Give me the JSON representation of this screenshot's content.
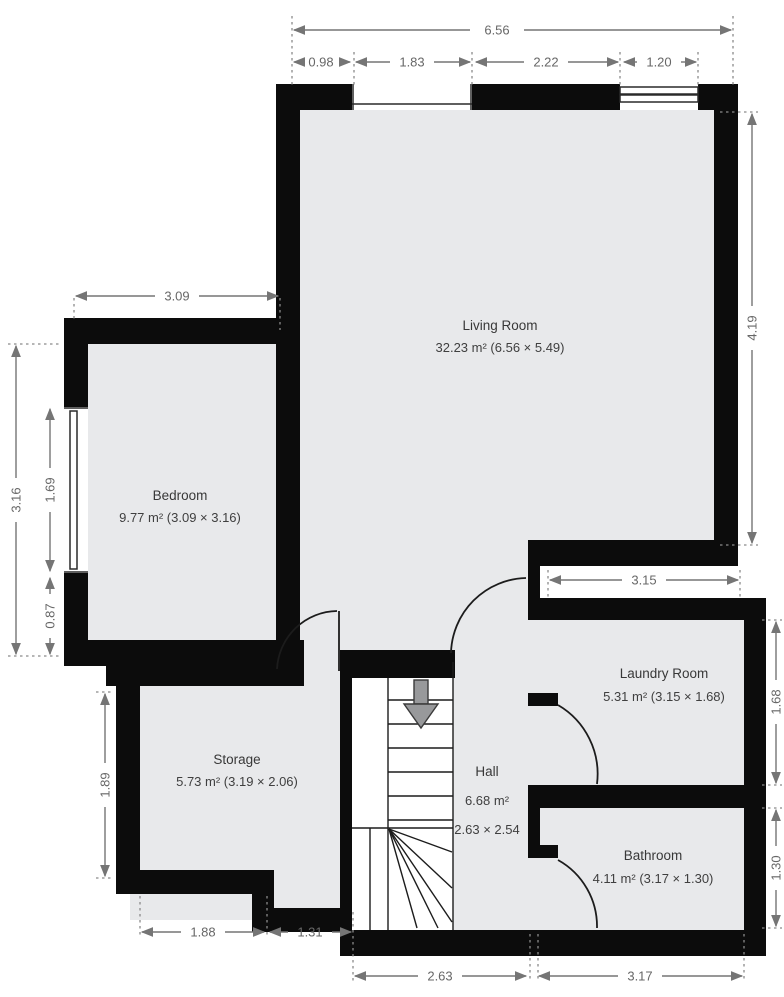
{
  "plan": {
    "rooms": {
      "living": {
        "name": "Living Room",
        "area": "32.23 m² (6.56 × 5.49)"
      },
      "bedroom": {
        "name": "Bedroom",
        "area": "9.77 m² (3.09 × 3.16)"
      },
      "storage": {
        "name": "Storage",
        "area": "5.73 m² (3.19 × 2.06)"
      },
      "hall": {
        "name": "Hall",
        "area": "6.68 m²",
        "size": "2.63 × 2.54"
      },
      "laundry": {
        "name": "Laundry Room",
        "area": "5.31 m² (3.15 × 1.68)"
      },
      "bathroom": {
        "name": "Bathroom",
        "area": "4.11 m² (3.17 × 1.30)"
      }
    },
    "dims": {
      "total_width": "6.56",
      "top_wall_left": "0.98",
      "top_window_left": "1.83",
      "top_wall_mid": "2.22",
      "top_window_right": "1.20",
      "bedroom_width": "3.09",
      "bedroom_height": "3.16",
      "bedroom_window": "1.69",
      "bedroom_below_window": "0.87",
      "living_right_height": "4.19",
      "laundry_width": "3.15",
      "laundry_height": "1.68",
      "bathroom_height": "1.30",
      "storage_height": "1.89",
      "storage_bottom_width": "1.88",
      "step_bottom_width": "1.31",
      "hall_bottom_width": "2.63",
      "bathroom_bottom_width": "3.17"
    },
    "colors": {
      "wall": "#0c0c0c",
      "floor": "#e8e9eb",
      "stairwell": "#ffffff",
      "dimension_line": "#757575",
      "label_text": "#383838"
    }
  }
}
